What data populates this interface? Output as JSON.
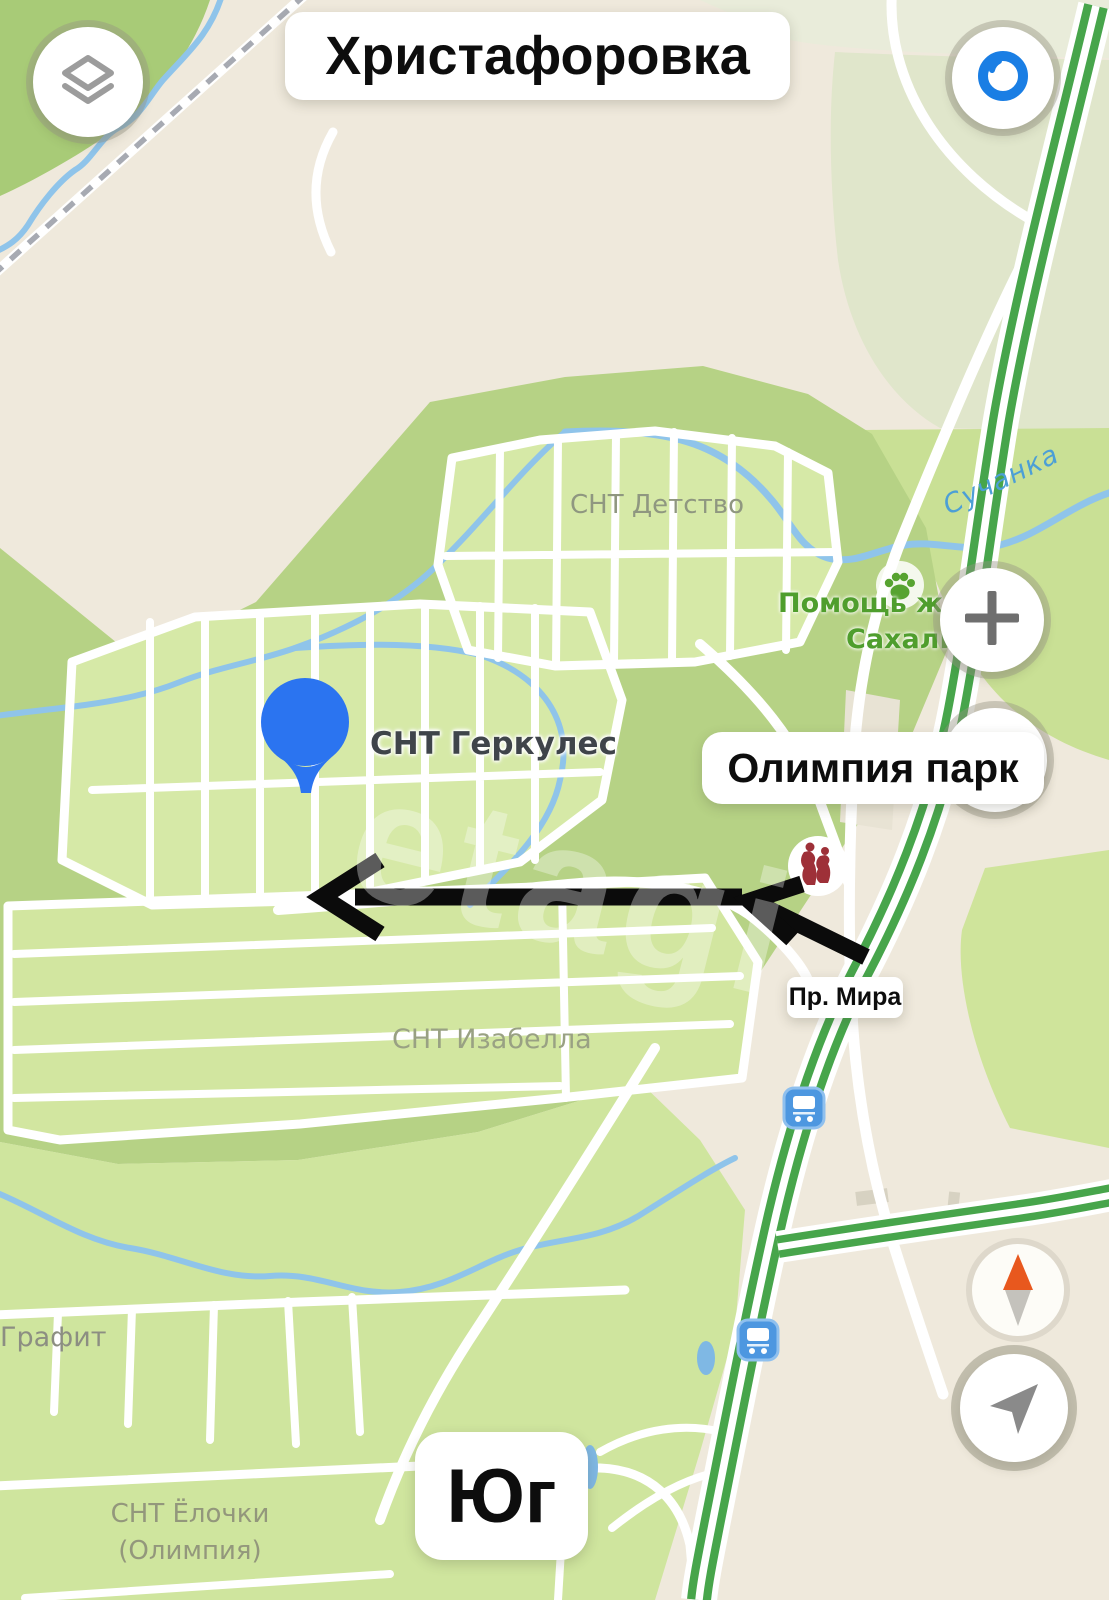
{
  "pills": {
    "settlement": "Христафоровка",
    "park": "Олимпия парк",
    "street": "Пр. Мира",
    "district": "Юг"
  },
  "map_labels": {
    "snt_detstvo": "СНТ Детство",
    "snt_gerkules": "СНТ Геркулес",
    "snt_izabella": "СНТ Изабелла",
    "grafit": "Графит",
    "snt_yolochki_line1": "СНТ Ёлочки",
    "snt_yolochki_line2": "(Олимпия)",
    "river": "Сучанка",
    "poi_animal_help_line1": "Помощь жи",
    "poi_animal_help_line2": "Сахали",
    "watermark": "etagi"
  },
  "controls": {
    "layers_icon": "layers-stack",
    "compass_mode_icon": "blue-dial",
    "zoom_in_icon": "plus",
    "zoom_out_icon": "minus",
    "compass_icon": "north-needle",
    "locate_icon": "navigation-arrow"
  },
  "markers": {
    "pin": "blue-balloon-pin",
    "bus_stop": "bus-stop",
    "monument": "monument-statue",
    "paw": "animal-paw",
    "route_arrow": "hand-drawn-black-arrow"
  },
  "colors": {
    "pin_blue": "#2B74F0",
    "highway_green": "#47A54B",
    "river_blue": "#8FC4EA",
    "poi_green": "#4F9E2D",
    "compass_north_orange": "#E8581E",
    "bus_blue": "#4D97E0",
    "monument_red": "#9E3038",
    "arrow_black": "#0B0B0B",
    "forest_green": "#B6D285",
    "plot_green": "#D6E9A7",
    "background_beige": "#EFE9DC"
  }
}
